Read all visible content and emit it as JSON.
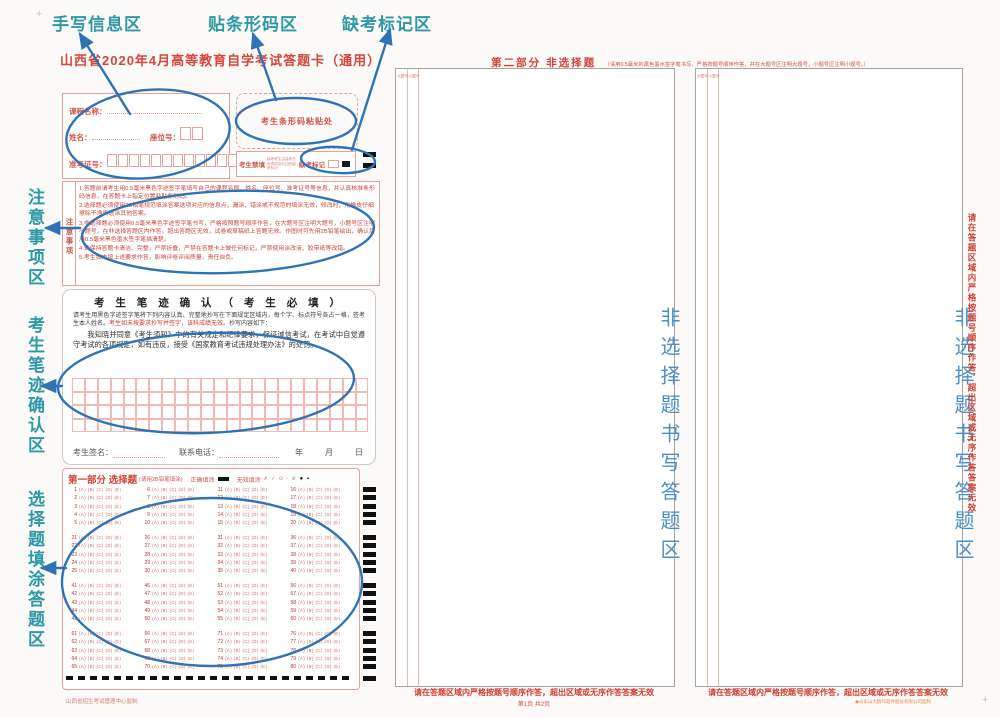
{
  "colors": {
    "sheet_red": "#cf5449",
    "annotation_teal": "#2d99a6",
    "annotation_blue": "#2e74b5",
    "area_blue": "#4a90c7"
  },
  "annotations": {
    "top_labels": [
      {
        "label": "手写信息区"
      },
      {
        "label": "贴条形码区"
      },
      {
        "label": "缺考标记区"
      }
    ],
    "left_labels": [
      {
        "label": "注意事项区"
      },
      {
        "label": "考生笔迹确认区"
      },
      {
        "label": "选择题填涂答题区"
      }
    ]
  },
  "page1": {
    "title": "山西省2020年4月高等教育自学考试答题卡（通用）",
    "info": {
      "course_label": "课程名称：",
      "name_label": "姓名：",
      "seat_label": "座位号：",
      "seat_box_count": 2,
      "admission_label": "准考证号：",
      "admission_box_count": 14
    },
    "barcode": {
      "label": "考生条形码粘贴处"
    },
    "absent": {
      "forbid_label": "考生禁填",
      "tiny_note": "缺考考生由监考员负责填涂右边的缺考标记",
      "mark_label": "缺考标记"
    },
    "notes": {
      "side_label": "注意事项",
      "items": [
        "1.答题前请考生用0.5毫米黑色字迹签字笔填写自己的课程名称、姓名、座位号、准考证号等信息，并认真核准条形码信息，在答题卡上指定位置粘贴条形码。",
        "2.选择题必须使用2B铅笔规范填涂答案选项对应的信息点，漏涂、错涂或不规范的填涂无效，修改时，用橡皮仔细擦除干净再选涂其他答案。",
        "3.非选择题必须使用0.5毫米黑色字迹签字笔书写，严格按照题号顺序作答，在大题号区注明大题号，小题号区注明小题号，在非选择答题区内作答，超出答题区无效，试卷或草稿纸上答题无效。作图时可先用2B铅笔绘出，确认后用0.5毫米黑色墨水签字笔描清楚。",
        "4.请保持答题卡清洁、完整，严禁折叠，严禁在答题卡上做任何标记，严禁使用涂改液、胶带纸等改错。",
        "5.考生如未按上述要求作答，影响评卷评阅质量，责任自负。"
      ]
    },
    "confirm": {
      "title": "考 生 笔 迹 确 认 （ 考 生 必 填 ）",
      "intro_black": "请考生用黑色字迹签字笔将下列内容认真、完整地抄写在下面规定区域内，每个字、标点符号各占一格，签考生本人姓名。",
      "intro_red": "考生如未按要求抄写并签字，该科成绩无效。",
      "intro_tail": "抄写内容如下：",
      "body": "我知晓并同意《考生须知》中的有关规定和纪律要求，保证诚信考试，在考试中自觉遵守考试的各项规定，如有违反，接受《国家教育考试违规处理办法》的处罚。",
      "grid": {
        "rows": 4,
        "cols": 23
      },
      "sign_label": "考生签名：",
      "phone_label": "联系电话：",
      "date_label": "年　　月　　日"
    },
    "part1": {
      "header": "第一部分 选择题",
      "header_note": "(请用2B铅笔填涂)",
      "correct_label": "正确填涂",
      "invalid_label": "无效填涂",
      "invalid_examples": "✗ ✓ ⊙ ◦ ⊘",
      "invalid_marks": "● ▪",
      "questions": {
        "start": 1,
        "end": 80,
        "options": [
          "A",
          "B",
          "C",
          "D",
          "E"
        ],
        "block_rows": 5,
        "cols": 4,
        "blocks": 4
      }
    },
    "footer": "山西省招生考试管理中心监制"
  },
  "page2": {
    "header": "第二部分 非选择题",
    "header_note": "（请用0.5毫米的黑色墨水签字笔书写，严格按题号顺序作答，并在大题号区注明大题号，小题号区注明小题号。）",
    "col_label": "大题号小题号",
    "area_text": "非选择题书写答题区",
    "side_warning": "请在答题区域内严格按题号顺序作答，超出区域或无序作答答案无效",
    "bottom_warning_left": "请在答题区域内严格按题号顺序作答，超出区域或无序作答答案无效",
    "bottom_warning_right": "请在答题区域内严格按题号顺序作答，超出区域或无序作答答案无效",
    "page_info": "第1页  共2页",
    "watermark": "◉山东山大鸥玛软件股份有限公司监制"
  }
}
